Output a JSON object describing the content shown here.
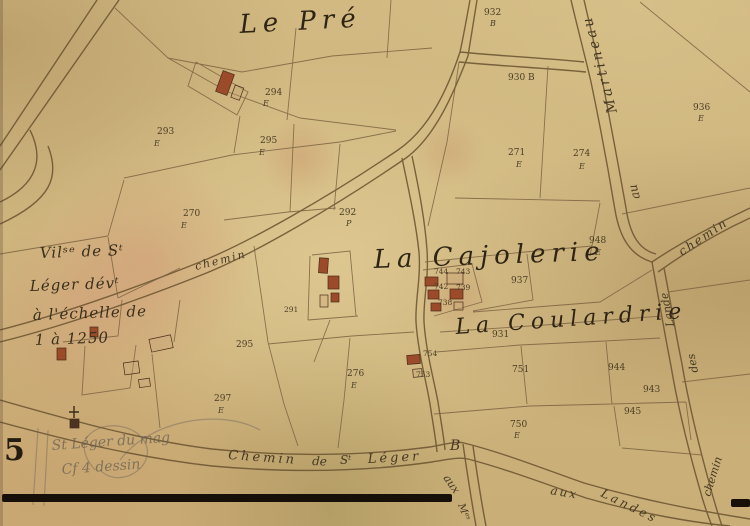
{
  "map": {
    "places": {
      "le_pre": "Le Pré",
      "la_cajolerie": "La Cajolerie",
      "la_coulardrie": "La Coulardrie"
    },
    "note": {
      "line1": "Vilˢᵉ de Sᵗ",
      "line2": "Léger dévᵗ",
      "line3": "à l'échelle de",
      "line4": "1 à 1250"
    },
    "roads": {
      "chemin_small": "chemin",
      "bottom_1": "Chemin",
      "bottom_2": "de",
      "bottom_3": "Sᵗ",
      "bottom_4": "Léger",
      "b_marker": "B",
      "aux_branch": "aux",
      "m_branch": "Mᵉˢ",
      "aux_landes_1": "aux",
      "aux_landes_2": "Landes",
      "martineau": "Martineau",
      "au": "au",
      "chemin_ne": "chemin",
      "lande": "Lande",
      "des": "des",
      "chemin_se": "chemin"
    },
    "sheet_number": "5",
    "pencil_note_1": "St Léger du mag",
    "pencil_note_2": "Cf 4 dessin",
    "parcels": [
      {
        "label": "932",
        "section": "B"
      },
      {
        "label": "930 B"
      },
      {
        "label": "294",
        "section": "E"
      },
      {
        "label": "293",
        "section": "E"
      },
      {
        "label": "295",
        "section": "E"
      },
      {
        "label": "292",
        "section": "P"
      },
      {
        "label": "270",
        "section": "E"
      },
      {
        "label": "271",
        "section": "E"
      },
      {
        "label": "274",
        "section": "E"
      },
      {
        "label": "936",
        "section": "E"
      },
      {
        "label": "948",
        "section": "E"
      },
      {
        "label": "937"
      },
      {
        "label": "931"
      },
      {
        "label": "295"
      },
      {
        "label": "297",
        "section": "E"
      },
      {
        "label": "276",
        "section": "E"
      },
      {
        "label": "754"
      },
      {
        "label": "753"
      },
      {
        "label": "751"
      },
      {
        "label": "750",
        "section": "E"
      },
      {
        "label": "944"
      },
      {
        "label": "943"
      },
      {
        "label": "945"
      },
      {
        "label": "291"
      },
      {
        "label": "744"
      },
      {
        "label": "743"
      },
      {
        "label": "742"
      },
      {
        "label": "739"
      },
      {
        "label": "738"
      }
    ]
  }
}
